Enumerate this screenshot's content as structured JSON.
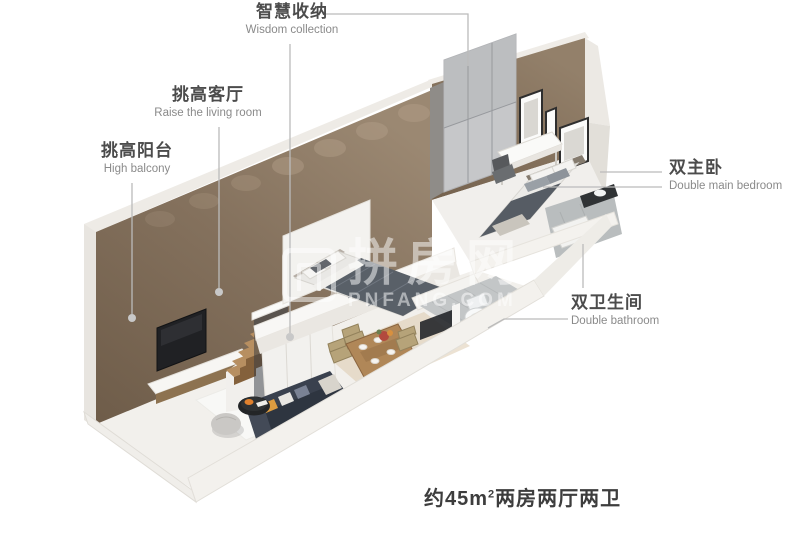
{
  "labels": {
    "storage": {
      "zh": "智慧收纳",
      "en": "Wisdom collection"
    },
    "living_room": {
      "zh": "挑高客厅",
      "en": "Raise the living room"
    },
    "balcony": {
      "zh": "挑高阳台",
      "en": "High balcony"
    },
    "main_bedroom": {
      "zh": "双主卧",
      "en": "Double main bedroom"
    },
    "bathroom": {
      "zh": "双卫生间",
      "en": "Double bathroom"
    }
  },
  "caption": {
    "area_prefix": "约45m",
    "area_sup": "2",
    "area_suffix": "两房两厅两卫"
  },
  "watermark": {
    "zh": "拼房网",
    "en": "PNFANG.COM"
  },
  "colors": {
    "background": "#ffffff",
    "wall_brown": "#84715d",
    "wall_brown_light": "#9b8872",
    "floor_white": "#f2f0ec",
    "tile_gray": "#c3c6c7",
    "sofa_dark": "#39404d",
    "wood": "#b08758",
    "leader_line": "#bbbbbb",
    "label_text": "#4c4c4c",
    "label_subtext": "#8a8a8a",
    "caption_text": "#3d3d3d"
  }
}
